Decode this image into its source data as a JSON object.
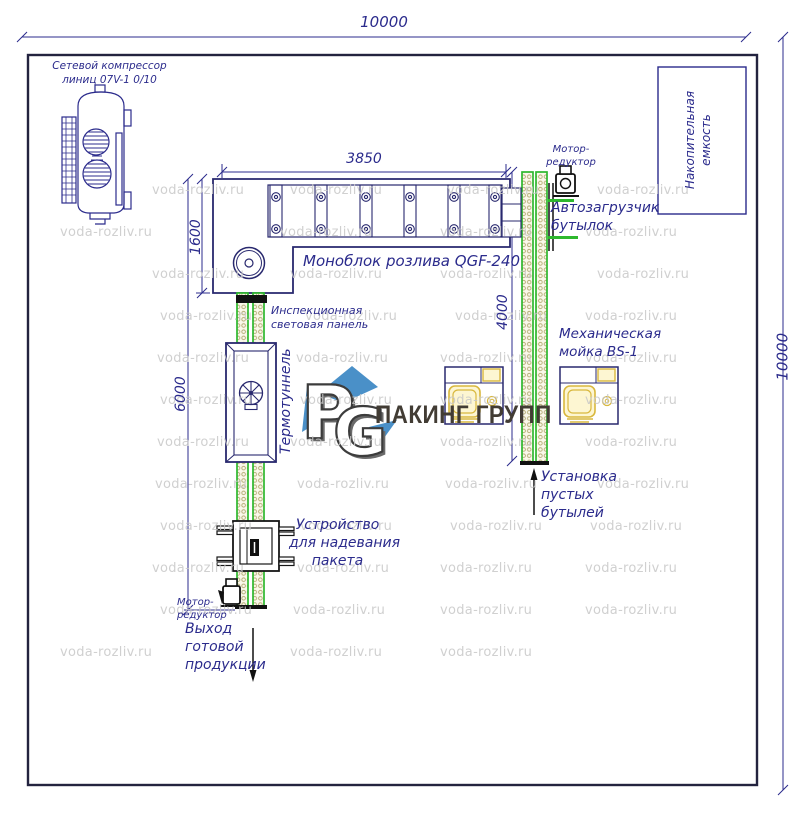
{
  "watermark": {
    "text": "voda-rozliv.ru",
    "color": "#c8c8c8",
    "positions": [
      [
        152,
        183
      ],
      [
        290,
        183
      ],
      [
        447,
        183
      ],
      [
        597,
        183
      ],
      [
        60,
        225
      ],
      [
        280,
        225
      ],
      [
        440,
        225
      ],
      [
        585,
        225
      ],
      [
        152,
        267
      ],
      [
        290,
        267
      ],
      [
        440,
        267
      ],
      [
        597,
        267
      ],
      [
        160,
        309
      ],
      [
        305,
        309
      ],
      [
        455,
        309
      ],
      [
        585,
        309
      ],
      [
        157,
        351
      ],
      [
        296,
        351
      ],
      [
        440,
        351
      ],
      [
        585,
        351
      ],
      [
        160,
        393
      ],
      [
        300,
        393
      ],
      [
        440,
        393
      ],
      [
        585,
        393
      ],
      [
        157,
        435
      ],
      [
        290,
        435
      ],
      [
        440,
        435
      ],
      [
        585,
        435
      ],
      [
        155,
        477
      ],
      [
        297,
        477
      ],
      [
        445,
        477
      ],
      [
        597,
        477
      ],
      [
        160,
        519
      ],
      [
        300,
        519
      ],
      [
        450,
        519
      ],
      [
        590,
        519
      ],
      [
        152,
        561
      ],
      [
        297,
        561
      ],
      [
        440,
        561
      ],
      [
        585,
        561
      ],
      [
        160,
        603
      ],
      [
        293,
        603
      ],
      [
        440,
        603
      ],
      [
        585,
        603
      ],
      [
        60,
        645
      ],
      [
        290,
        645
      ],
      [
        440,
        645
      ]
    ]
  },
  "dims": {
    "top": "10000",
    "right": "10000",
    "monoblock_width": "3850",
    "monoblock_depth": "1600",
    "left_line": "6000",
    "right_line": "4000"
  },
  "labels": {
    "compressor_1": "Сетевой компрессор",
    "compressor_2": "линиц 07V-1 0/10",
    "storage_1": "Накопительная",
    "storage_2": "емкость",
    "monoblock": "Моноблок розлива QGF-240",
    "motor_top_1": "Мотор-",
    "motor_top_2": "редуктор",
    "autoloader_1": "Автозагрузчик",
    "autoloader_2": "бутылок",
    "inspection_1": "Инспекционная",
    "inspection_2": "световая панель",
    "thermotunnel": "Термотуннель",
    "washer_1": "Механическая",
    "washer_2": "мойка BS-1",
    "bottles_1": "Установка",
    "bottles_2": "пустых",
    "bottles_3": "бутылей",
    "bag_1": "Устройство",
    "bag_2": "для надевания",
    "bag_3": "пакета",
    "motor_bottom_1": "Мотор-",
    "motor_bottom_2": "редуктор",
    "output_1": "Выход",
    "output_2": "готовой",
    "output_3": "продукции",
    "logo_p": "P",
    "logo_g": "G",
    "logo_text": "ПАКИНГ ГРУПП"
  },
  "colors": {
    "line_navy": "#2b2b8c",
    "frame_dark": "#23233f",
    "conveyor_green": "#2eb82e",
    "chain_olive": "#b3aa72",
    "washer_yellow": "#d9b83e",
    "logo_blue": "#4a90c8",
    "watermark_gray": "#c8c8c8",
    "black_parts": "#111111"
  }
}
